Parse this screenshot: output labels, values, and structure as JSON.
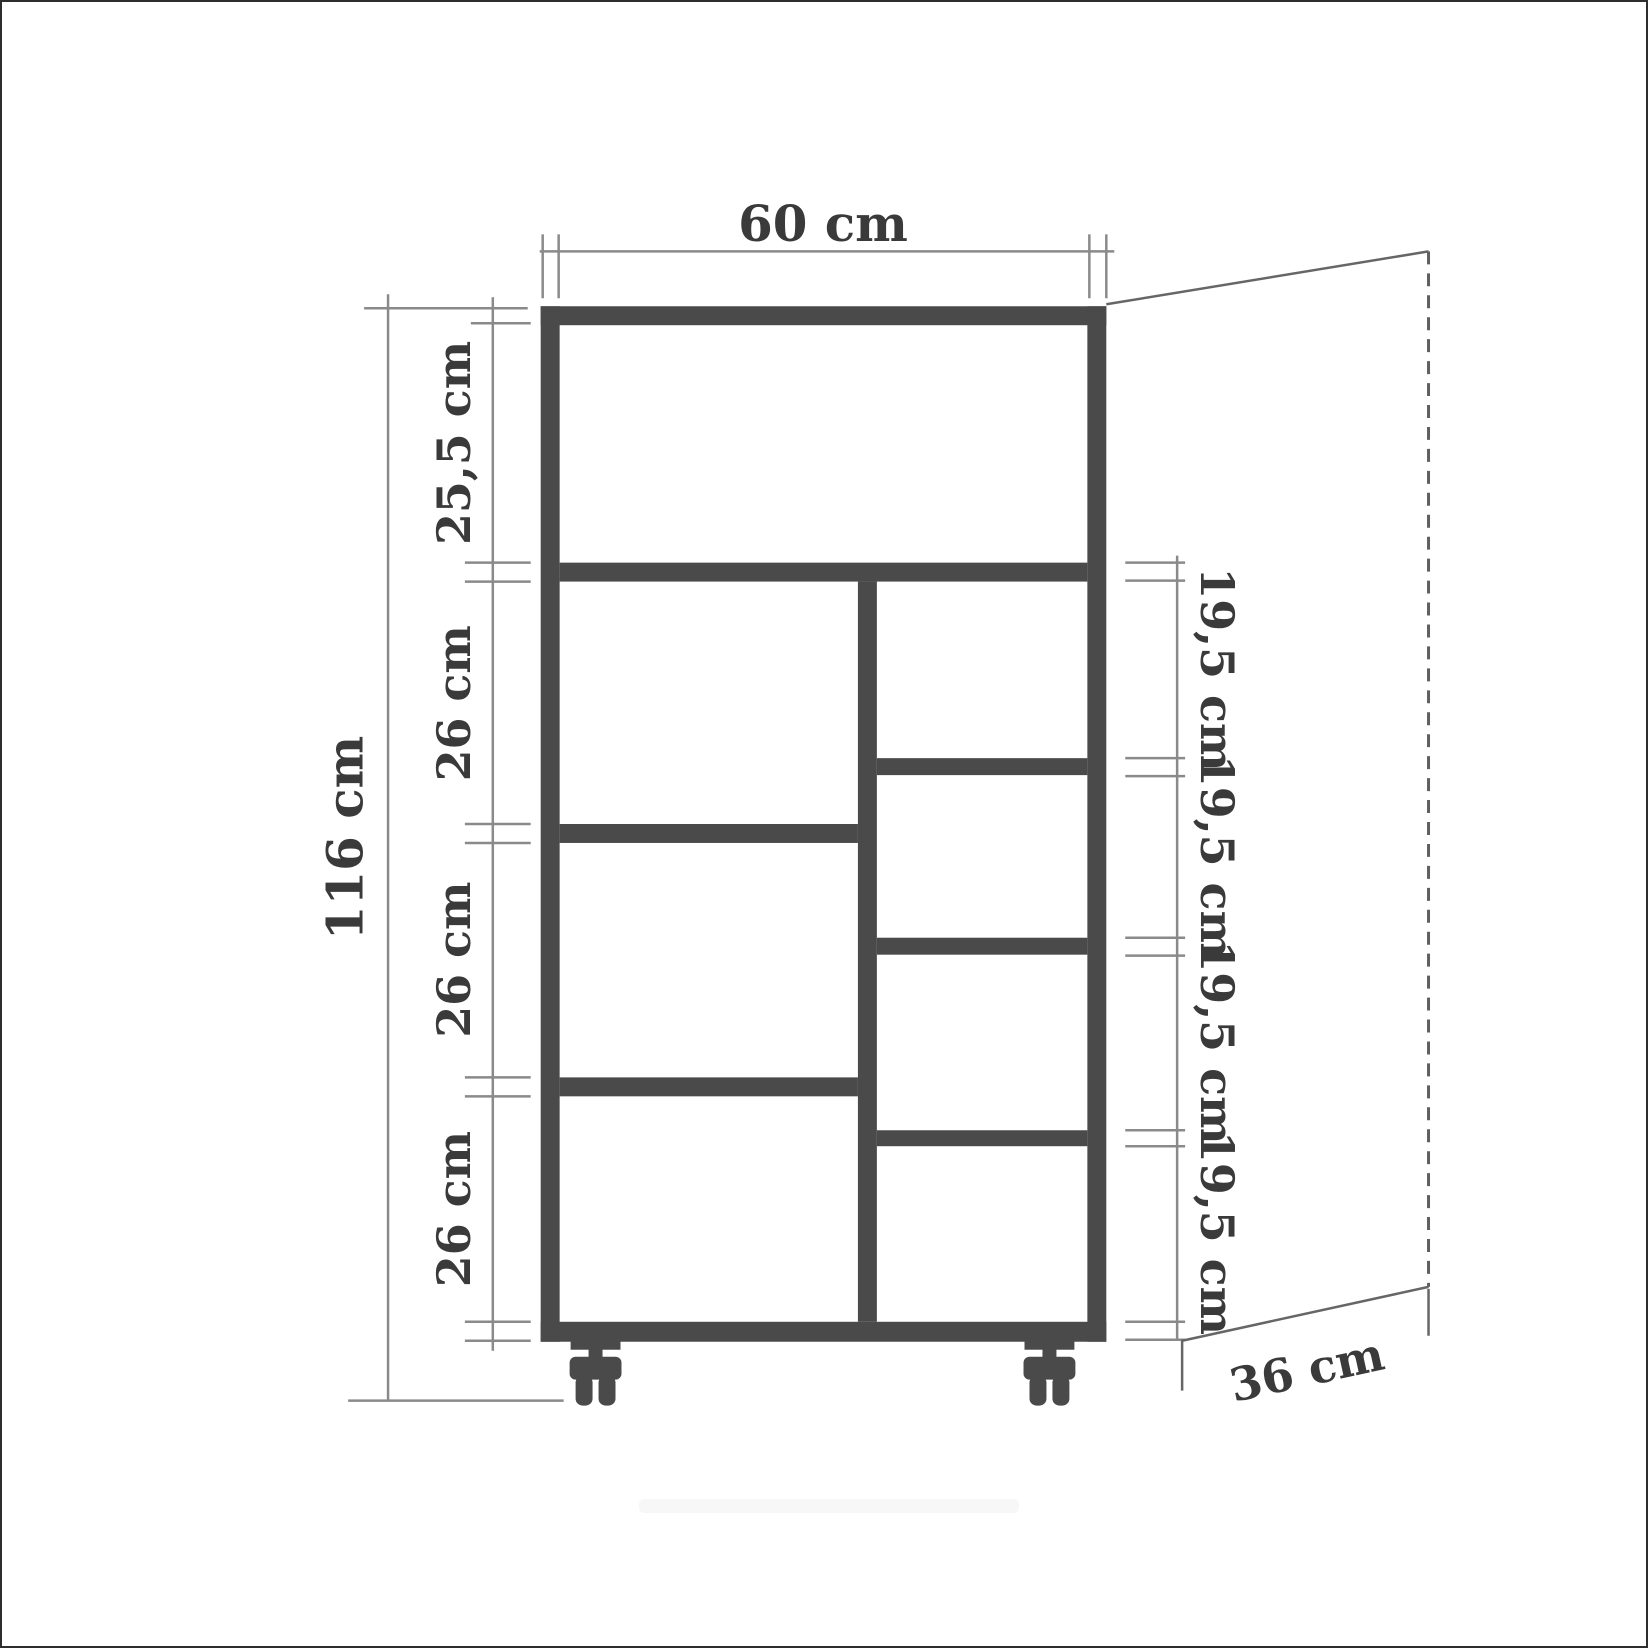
{
  "drawing": {
    "type": "furniture-dimension-diagram",
    "object": "shelving-cabinet-on-casters",
    "unit": "cm",
    "labels": {
      "width_top": "60 cm",
      "height_left": "116 cm",
      "depth_bottom_right": "36 cm",
      "left_inner": [
        "25,5 cm",
        "26 cm",
        "26 cm",
        "26 cm"
      ],
      "right_inner": [
        "19,5 cm",
        "19,5 cm",
        "19,5 cm",
        "19,5 cm"
      ]
    },
    "structure": {
      "top_full_width_compartments": 1,
      "left_column_compartments": 3,
      "right_column_compartments": 4,
      "casters": 2
    },
    "colors": {
      "structure": "#4a4a4a",
      "dimension_line": "#8a8a8a",
      "projection_line": "#666666",
      "text": "#3a3a3a",
      "background": "#ffffff",
      "page_border": "#2e2e2e"
    }
  }
}
